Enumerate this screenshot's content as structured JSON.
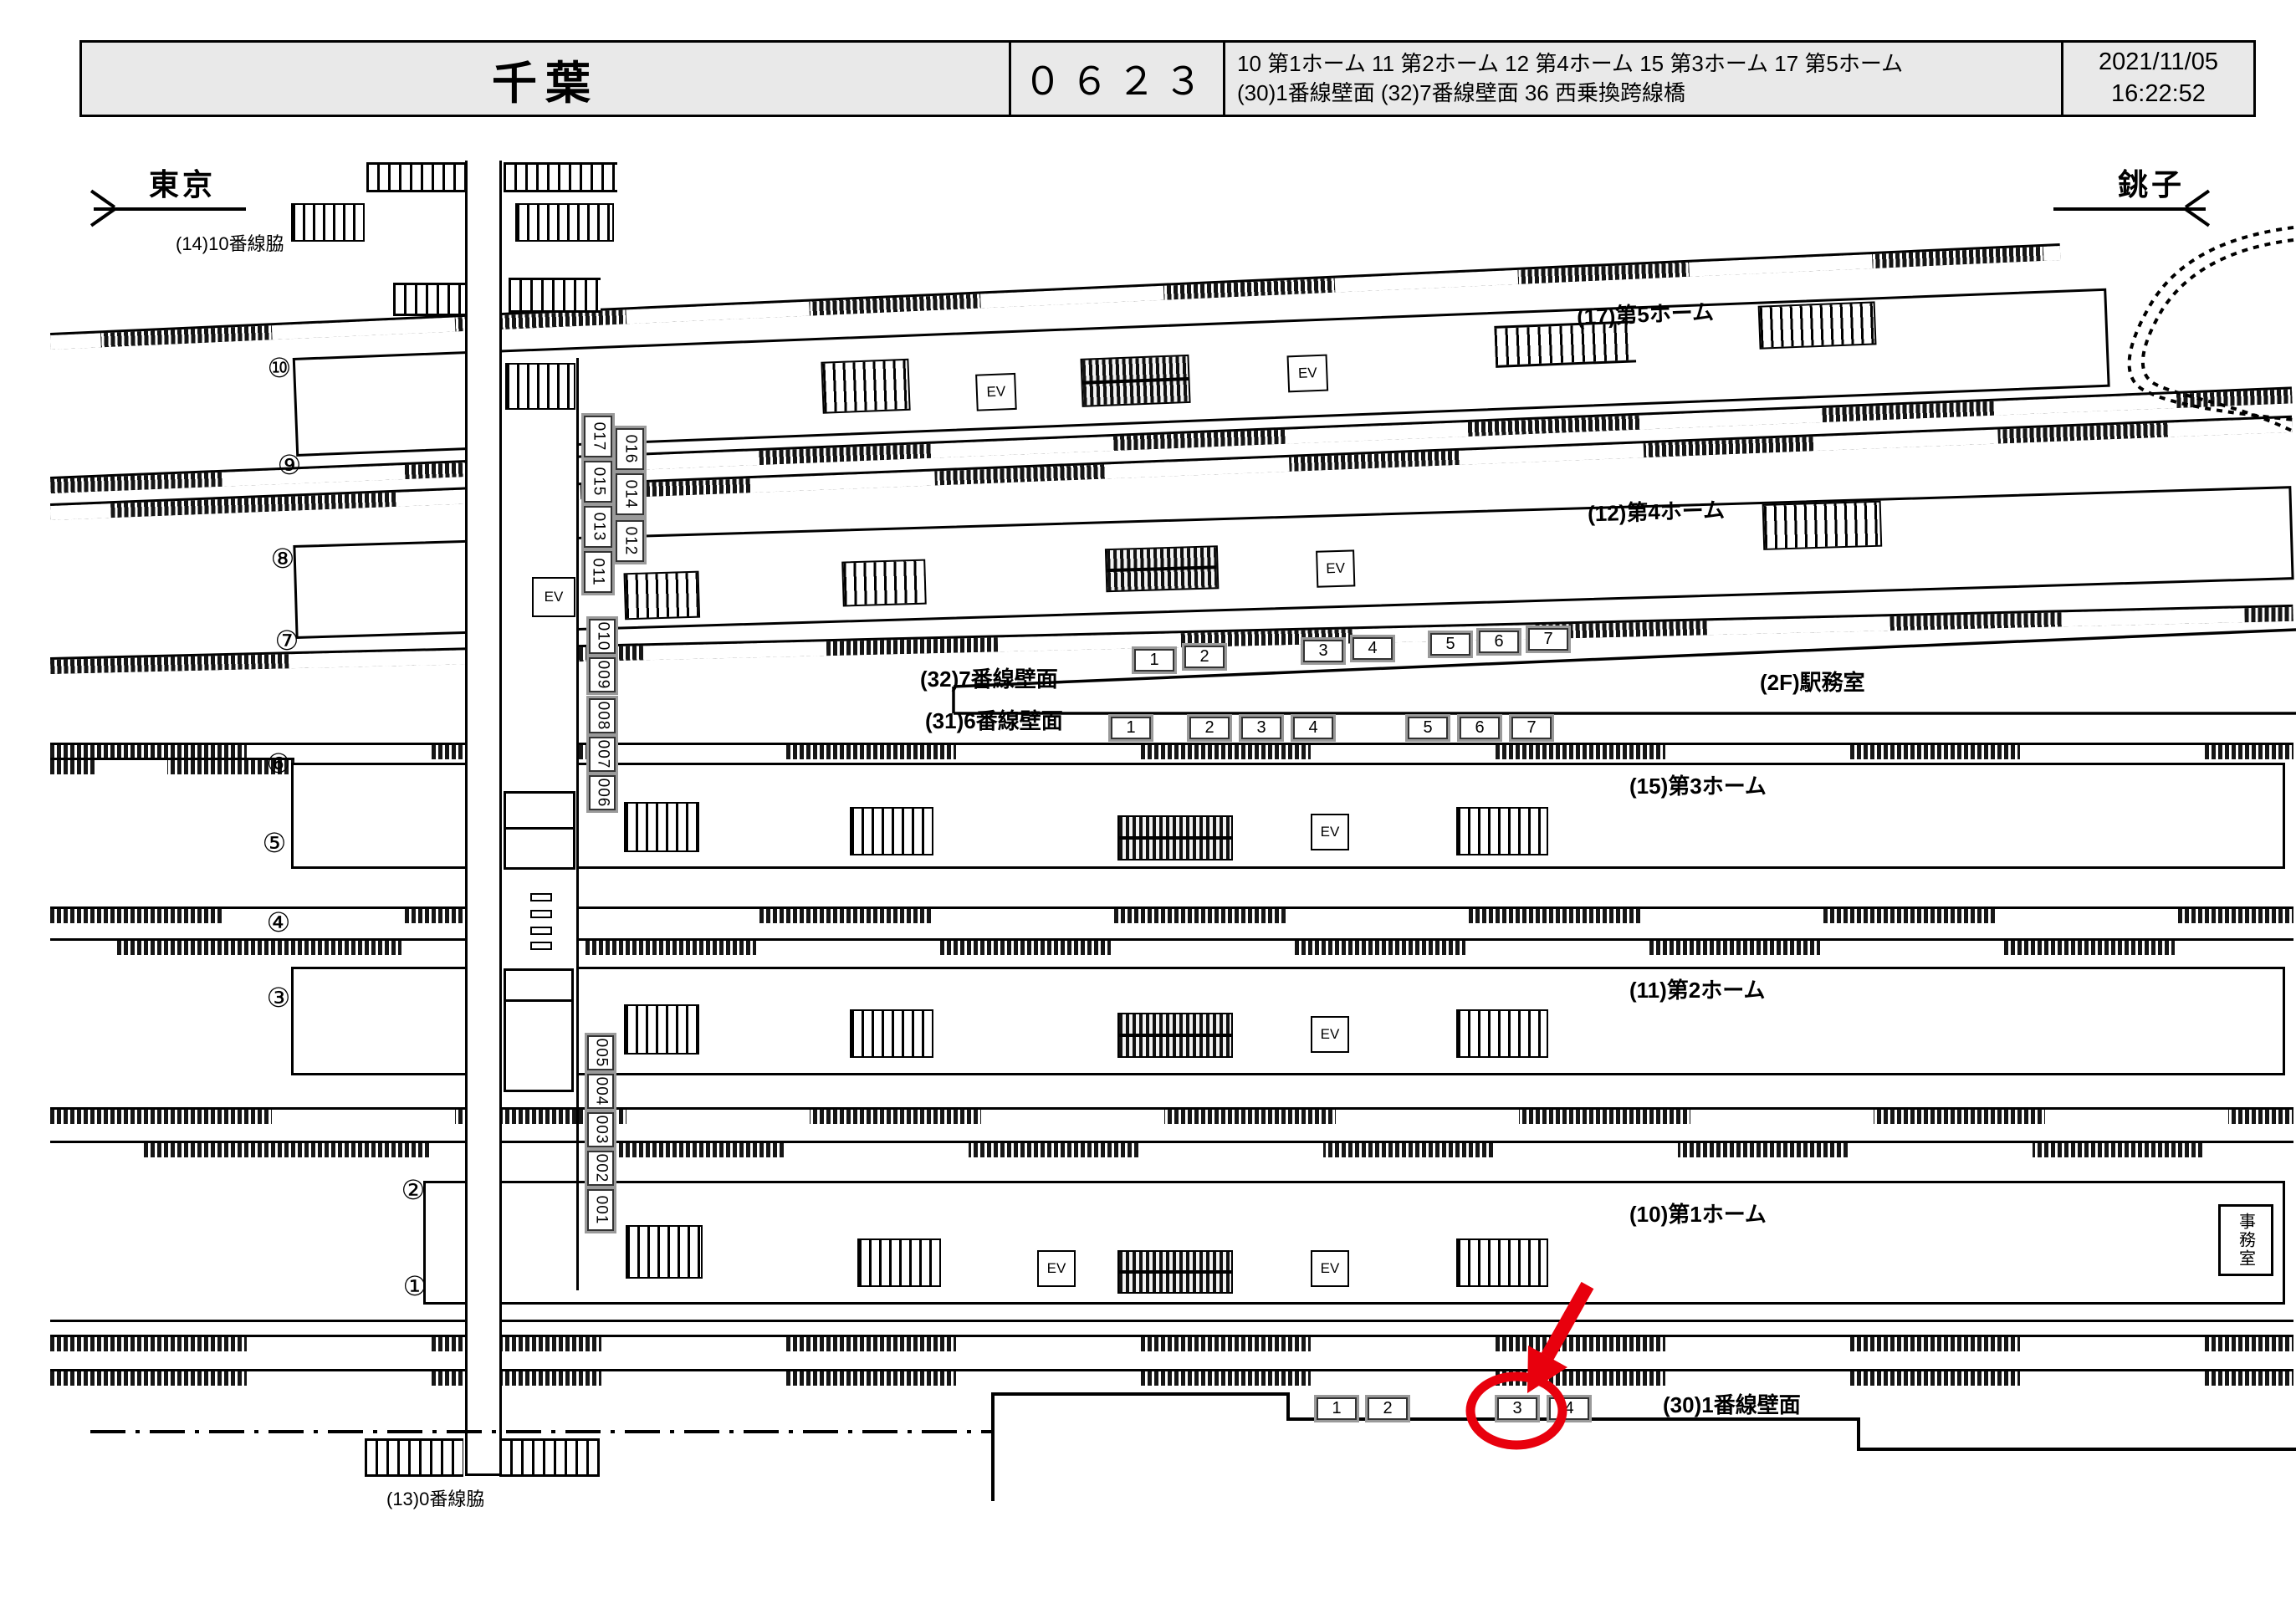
{
  "header": {
    "station": "千葉",
    "code": "０６２３",
    "legend_line1": "10 第1ホーム  11 第2ホーム  12 第4ホーム 15 第3ホーム  17 第5ホーム",
    "legend_line2": "(30)1番線壁面  (32)7番線壁面  36 西乗換跨線橋",
    "date": "2021/11/05",
    "time": "16:22:52"
  },
  "directions": {
    "left": "東京",
    "right": "銚子"
  },
  "area_labels": {
    "track10side": "(14)10番線脇",
    "platform5": "(17)第5ホーム",
    "platform4": "(12)第4ホーム",
    "platform3": "(15)第3ホーム",
    "platform2": "(11)第2ホーム",
    "platform1": "(10)第1ホーム",
    "wall7": "(32)7番線壁面",
    "wall6": "(31)6番線壁面",
    "office2f": "(2F)駅務室",
    "wall1": "(30)1番線壁面",
    "track0side": "(13)0番線脇",
    "office": "事務室",
    "ev": "EV"
  },
  "corridor_numbers": {
    "upper_left": [
      "017",
      "015",
      "013",
      "011"
    ],
    "upper_right": [
      "016",
      "014",
      "012"
    ],
    "middle": [
      "010",
      "009",
      "008",
      "007",
      "006"
    ],
    "lower": [
      "005",
      "004",
      "003",
      "002",
      "001"
    ]
  },
  "wall7_boxes": [
    "1",
    "2",
    "3",
    "4",
    "5",
    "6",
    "7"
  ],
  "wall6_boxes": [
    "1",
    "2",
    "3",
    "4",
    "5",
    "6",
    "7"
  ],
  "wall1_boxes": [
    "1",
    "2",
    "3",
    "4"
  ],
  "platform_end_numbers": {
    "p5": [
      "⑩",
      "⑨"
    ],
    "p4": [
      "⑧",
      "⑦"
    ],
    "p3": [
      "⑥",
      "⑤"
    ],
    "p2": [
      "④",
      "③"
    ],
    "p1": [
      "②",
      "①"
    ]
  },
  "highlight": {
    "target_box": "3",
    "color": "#e8000d"
  }
}
